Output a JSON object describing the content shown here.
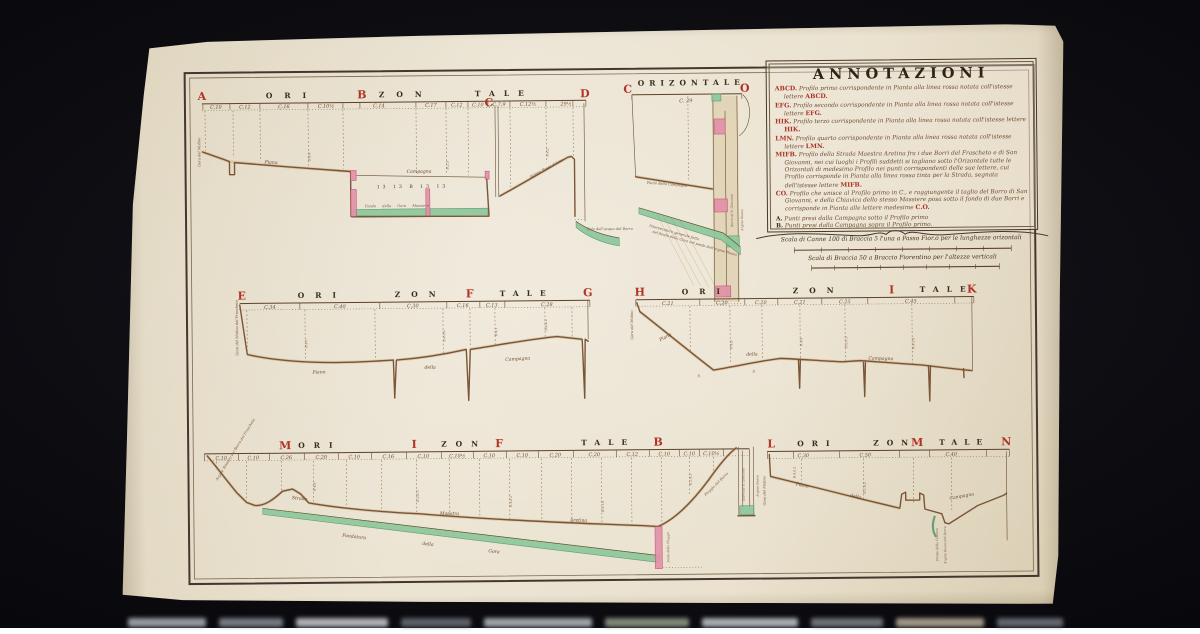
{
  "annotations": {
    "title": "ANNOTAZIONI",
    "entries": [
      {
        "key": "ABCD.",
        "text": "Profilo primo corrispondente in Pianta alla linea rossa notata coll'istesse lettere",
        "tail": "ABCD."
      },
      {
        "key": "EFG.",
        "text": "Profilo secondo corrispondente in Pianta alla linea rossa notata coll'istesse lettere",
        "tail": "EFG."
      },
      {
        "key": "HIK.",
        "text": "Profilo terzo corrispondente in Pianta alla linea rossa notata coll'istesse lettere",
        "tail": "HIK."
      },
      {
        "key": "LMN.",
        "text": "Profilo quarto corrispondente in Pianta alla linea rossa notata coll'istesse lettere",
        "tail": "LMN."
      },
      {
        "key": "MIFB.",
        "text": "Profilo della Strada Maestra Aretina fra i due Borri del Frascheto e di San Giovanni, nei cui luoghi i Profili suddetti si tagliano sotto l'Orizontale tutte le Orizontali di medesimo Profilo nei punti corrispondenti delle sue lettere, cui Profilo corrisponde in Pianta alla linea rossa tinta per la Strada, segnata dell'istesse lettere",
        "tail": "MIFB."
      },
      {
        "key": "CO.",
        "text": "Profilo che unisce al Profilo primo in C., e raggiungente il taglio del Borro di San Giovanni, e della Chiavica dello stesso Massiere posa sotto il fondo di due Borri e corrisponde in Pianta alle lettere medesime",
        "tail": "C.O."
      }
    ],
    "points": [
      {
        "key": "A.",
        "text": "Punti presi dalla Campagna sotto il Profilo primo"
      },
      {
        "key": "B.",
        "text": "Punti presi dalla Campagna sopra il Profilo primo."
      },
      {
        "key": "C.",
        "text": "Punti presi dalla Campagna in vicinanza dei Profili terzo e quarto"
      },
      {
        "key": "D.",
        "text": "Punti presi dalla Campagna sopra la Strada Maestra Aretina."
      },
      {
        "key": "E.",
        "text": "Punti presi dalla Campagna sotto alla Strada Maestra Aretina."
      }
    ]
  },
  "scales": {
    "horizontal": "Scala di Canne 100 di Braccia 5 l'una a Passo Fior.o per le lunghezze orizontali",
    "vertical": "Scala di Braccia 50 a Braccio Fiorentino per l'altezze verticali"
  },
  "profiles": {
    "p1": {
      "letters": [
        "A",
        "ORI",
        "B",
        "ZON",
        "TALE",
        "D"
      ],
      "c": "C",
      "ticks": [
        "C.10",
        "C.12",
        "C.16",
        "C.10½",
        "C.14",
        "C.17",
        "C.12",
        "C.10",
        "C.7.9",
        "C.12½",
        "29½"
      ],
      "labels": {
        "piano": "Piano",
        "campagna": "Campagna",
        "fondo": "Fondo della Gora Massiere",
        "argine": "Argine Rosso d'Arno",
        "pelo": "Pelo dell'acqua del Borro",
        "gora": "Gora del Molino"
      },
      "marks": "13  13  B  13  13",
      "vmarks": [
        "B.4.6",
        "B.2.3",
        "B.4.2"
      ]
    },
    "pco": {
      "title": "ORIZONTALE",
      "left": "C",
      "right": "O",
      "tick": "C. 29",
      "labels": {
        "piano": "Piano della Campagna",
        "inter1": "Intersecatura generale fatta",
        "inter2": "nel fondo della Gora nel piede dell'argine Rosso",
        "borro": "Borro di S. Giovanni",
        "argine": "Argine Rosso"
      }
    },
    "p2": {
      "letters": [
        "E",
        "ORI",
        "ZON",
        "F",
        "TALE",
        "G"
      ],
      "ticks": [
        "C.34",
        "C.40",
        "C.30",
        "C.16",
        "C.13",
        "C.28"
      ],
      "labels": {
        "piano": "Piano",
        "della": "della",
        "campagna": "Campagna",
        "gora": "Gora del Molino del Frascheto"
      },
      "vmarks": [
        "B.4.0",
        "B.4.0½",
        "B.4.1",
        "B.4.6.2"
      ]
    },
    "p3": {
      "letters": [
        "H",
        "ORI",
        "ZON",
        "I",
        "TALE",
        "K"
      ],
      "ticks": [
        "C.21",
        "C.20",
        "C.20",
        "C.21",
        "C.25",
        "C.45"
      ],
      "labels": {
        "piano": "Piano",
        "della": "della",
        "campagna": "Campagna",
        "gora": "Gora del Molino"
      },
      "mark": "B.",
      "vmarks": [
        "B.4.6",
        "B.4.8",
        "B.2.0.2",
        "B.4.2.6"
      ]
    },
    "p4": {
      "letters": [
        "M",
        "ORI",
        "I",
        "ZON",
        "F",
        "TALE",
        "B"
      ],
      "ticks": [
        "C.10",
        "C.10",
        "C.26",
        "C.20",
        "C.10",
        "C.16",
        "C.10",
        "C.10½",
        "C.10",
        "C.10",
        "C.20",
        "C.20",
        "C.12",
        "C.10",
        "C.10",
        "C.10½"
      ],
      "labels": {
        "strada": "Strada",
        "maestra": "Maestra",
        "aretina": "Aretina",
        "fondatura": "Fondatura",
        "della": "della",
        "gora": "Gora",
        "piaggia": "Piaggia del Borro",
        "argine_l": "Argine Sinistro del Borro del Frascheto",
        "scalo": "Scalo della Piaggia",
        "borro": "Borro di S. Giovanni",
        "argine_r": "Argine Rosso"
      },
      "vmarks": [
        "B.4.6",
        "B.2.6.3",
        "B.4.6.2",
        "B.4.1.6",
        "B.2.4.2"
      ]
    },
    "p5": {
      "letters": [
        "L",
        "ORI",
        "ZON",
        "M",
        "TALE",
        "N"
      ],
      "ticks": [
        "C.30",
        "C.50",
        "C.40"
      ],
      "labels": {
        "piano": "Piano",
        "della": "della",
        "campagna": "Campagna",
        "gora": "Gora del Molino",
        "fondo": "Fondo della Colonna",
        "argine": "Argine Rosso del Borro"
      },
      "vmarks": [
        "B.4.0.2",
        "B.2.6.2"
      ]
    }
  },
  "colors": {
    "background": "#0c0c11",
    "paper": "#e9e0cc",
    "frame_ink": "#46372e",
    "profile_ink": "#7a5536",
    "letter_red": "#b13327",
    "water_green": "#8cc79b",
    "wall_pink": "#e392a8"
  }
}
